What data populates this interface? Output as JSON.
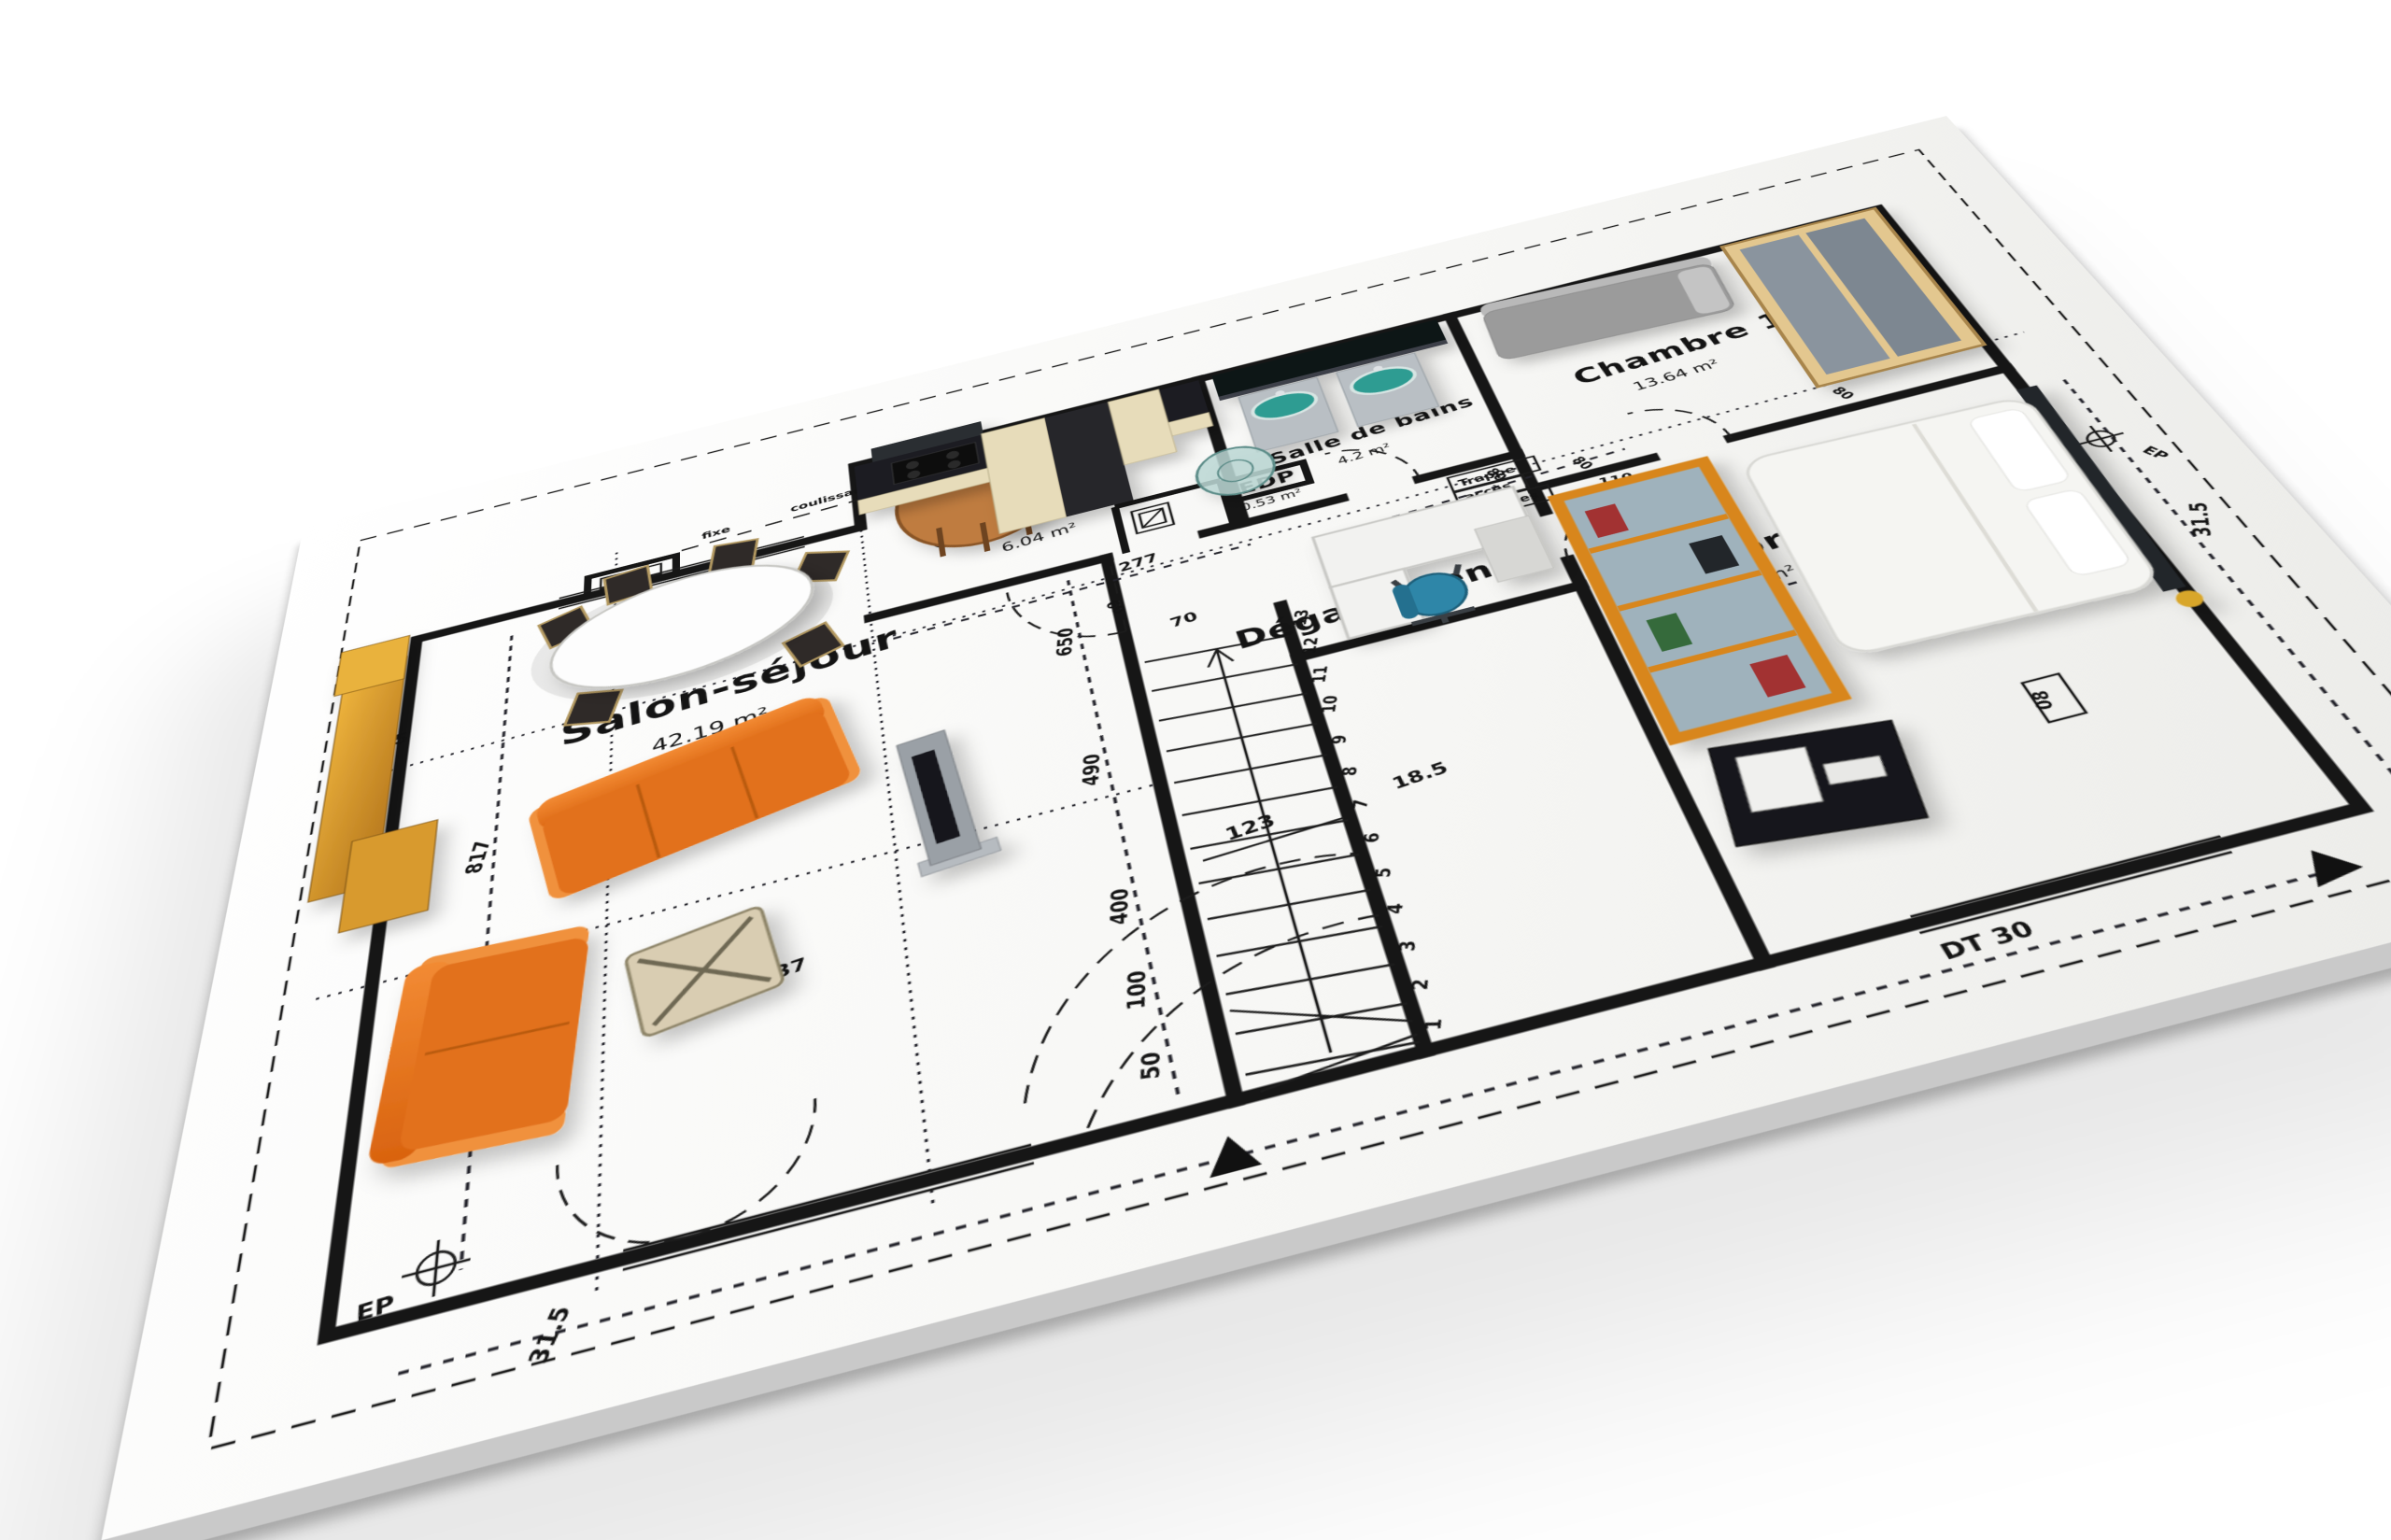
{
  "scene": {
    "description": "3D render of an architectural floor plan blueprint with furniture",
    "background": "#ffffff",
    "paper": "#fbfbfa",
    "ink": "#141414",
    "shadow": "#c9c9c9",
    "orange": "#e2711d",
    "gold": "#d89a2f",
    "teal": "#2f9c92",
    "blue": "#2e86a8",
    "wood": "#bf7c3f",
    "cream": "#e7dcba"
  },
  "rooms": {
    "salon": {
      "label": "Salon-séjour",
      "area": "42.19 m²"
    },
    "cuisine": {
      "label": "Cuisine",
      "area": "6.04 m²"
    },
    "bains": {
      "label": "Salle de bains",
      "area": "4.2 m²"
    },
    "degagement": {
      "label": "Dégagement"
    },
    "edp": {
      "label": "EDP",
      "area": "0.53 m²"
    },
    "chambre1": {
      "label": "Chambre 1",
      "area": "13.64 m²"
    },
    "chambre2": {
      "label": "Chambre 2",
      "area": "9 m²"
    }
  },
  "annotations": {
    "trappe1": "Trappe",
    "trappe2": "accès",
    "trappe3": "combles",
    "ep": "EP",
    "fixe": "fixe",
    "coulissant": "coulissant"
  },
  "dims": {
    "l315": "31.5",
    "b315": "31.5",
    "r315": "31.5",
    "d817": "817",
    "d650": "650",
    "d490": "490",
    "d400": "400",
    "d100": "100",
    "d50": "50",
    "d123": "123",
    "d185": "18.5",
    "d37": "37",
    "d277": "277",
    "d70": "70",
    "d60": "60",
    "d80a": "80",
    "d80b": "80",
    "d80c": "80",
    "d300": "300",
    "d243": "243",
    "d110": "110",
    "dt30": "DT 30",
    "code08a": "08",
    "code08b": "08"
  },
  "stairs": {
    "steps": [
      "1",
      "2",
      "3",
      "4",
      "5",
      "6",
      "7",
      "8",
      "9",
      "10",
      "11",
      "12",
      "13"
    ]
  }
}
